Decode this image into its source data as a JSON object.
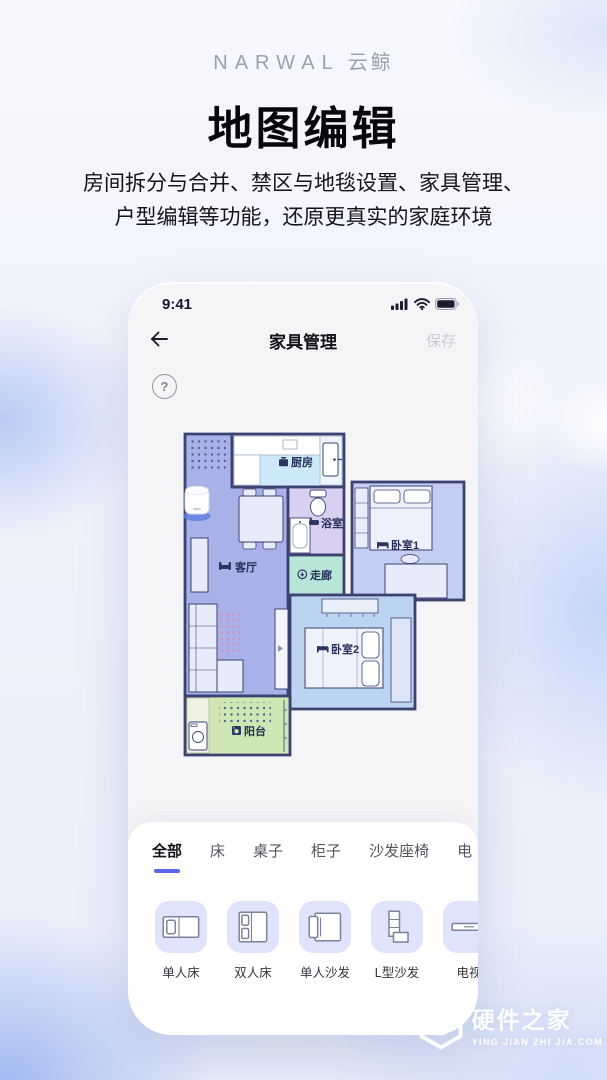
{
  "page": {
    "brand": {
      "name": "NARWAL",
      "suffix": "云鲸"
    },
    "title": "地图编辑",
    "subtitle_line1": "房间拆分与合并、禁区与地毯设置、家具管理、",
    "subtitle_line2": "户型编辑等功能，还原更真实的家庭环境",
    "footer_note": "适用部分产品",
    "watermark": {
      "name": "硬件之家",
      "domain": "YING JIAN ZHI JIA.COM"
    }
  },
  "phone": {
    "status_bar": {
      "time": "9:41",
      "icons": [
        "cellular-signal-icon",
        "wifi-icon",
        "battery-icon"
      ]
    },
    "nav": {
      "title": "家具管理",
      "save_label": "保存"
    },
    "help_label": "?",
    "map": {
      "wall_color": "#3c4370",
      "rooms": [
        {
          "id": "kitchen",
          "label": "厨房",
          "icon": "cooking-pot-icon",
          "color": "#cbe9f8"
        },
        {
          "id": "bathroom",
          "label": "浴室",
          "icon": "bathtub-icon",
          "color": "#d9cff1"
        },
        {
          "id": "corridor",
          "label": "走廊",
          "icon": "corridor-icon",
          "color": "#b7e6d9"
        },
        {
          "id": "bedroom1",
          "label": "卧室1",
          "icon": "bed-icon",
          "color": "#c4cdf4"
        },
        {
          "id": "living",
          "label": "客厅",
          "icon": "sofa-icon",
          "color": "#a9b1e9"
        },
        {
          "id": "bedroom2",
          "label": "卧室2",
          "icon": "bed-icon",
          "color": "#bdd3f2"
        },
        {
          "id": "balcony",
          "label": "阳台",
          "icon": "washing-machine-icon",
          "color": "#cfe7b5"
        }
      ]
    },
    "sheet": {
      "active_accent": "#5868e8",
      "tabs": [
        {
          "label": "全部",
          "active": true
        },
        {
          "label": "床"
        },
        {
          "label": "桌子"
        },
        {
          "label": "柜子"
        },
        {
          "label": "沙发座椅"
        },
        {
          "label": "电"
        }
      ],
      "items": [
        {
          "label": "单人床",
          "icon": "single-bed-icon"
        },
        {
          "label": "双人床",
          "icon": "double-bed-icon"
        },
        {
          "label": "单人沙发",
          "icon": "single-sofa-icon"
        },
        {
          "label": "L型沙发",
          "icon": "l-sofa-icon"
        },
        {
          "label": "电视",
          "icon": "tv-cabinet-icon"
        }
      ]
    }
  }
}
